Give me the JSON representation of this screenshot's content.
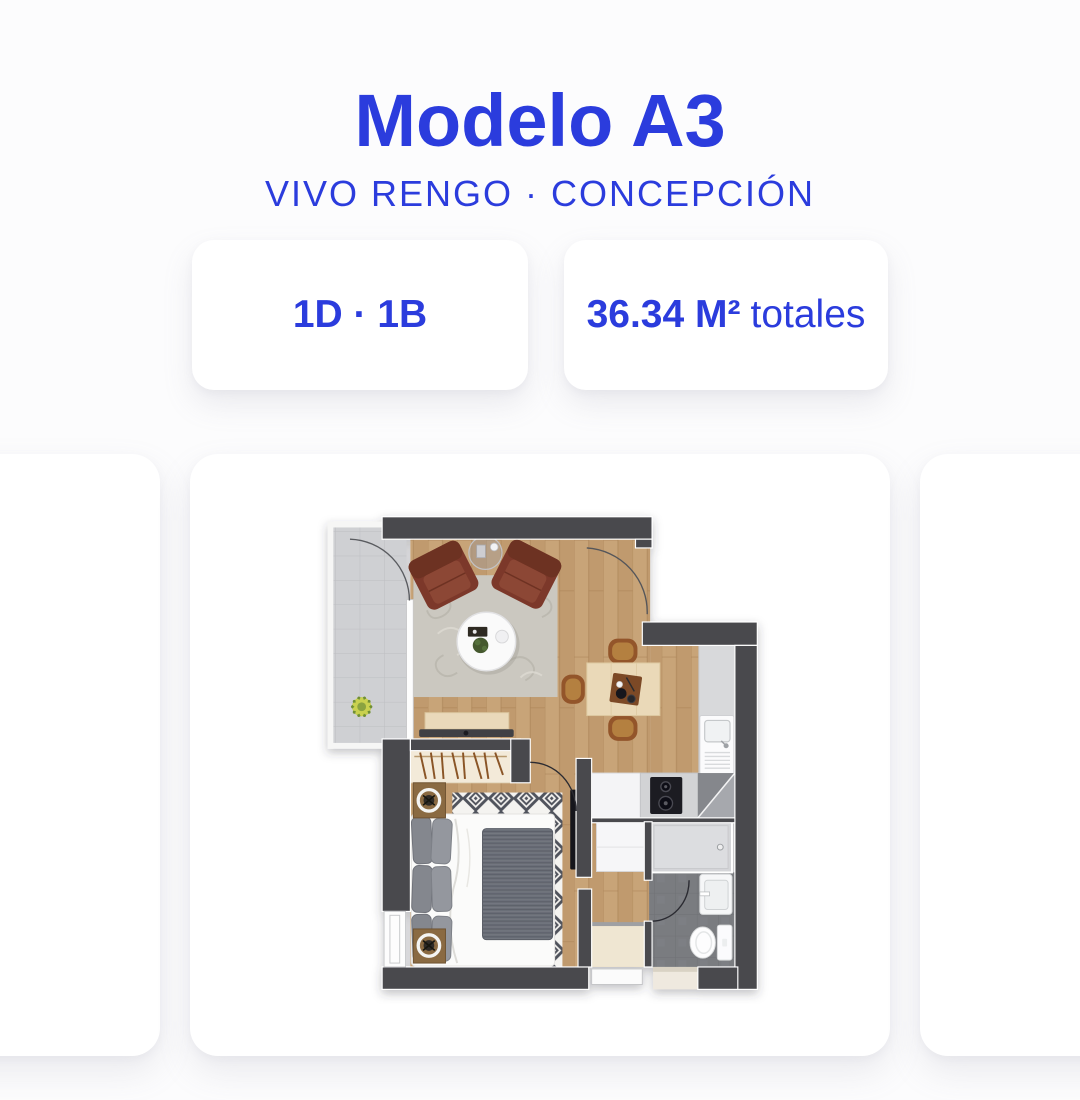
{
  "colors": {
    "accent": "#2b3cdd",
    "page_bg": "#fcfcfd",
    "card_bg": "#ffffff"
  },
  "header": {
    "title": "Modelo A3",
    "subtitle": "VIVO RENGO · CONCEPCIÓN"
  },
  "stats": {
    "rooms": "1D · 1B",
    "area_value": "36.34 M²",
    "area_suffix": "totales"
  }
}
